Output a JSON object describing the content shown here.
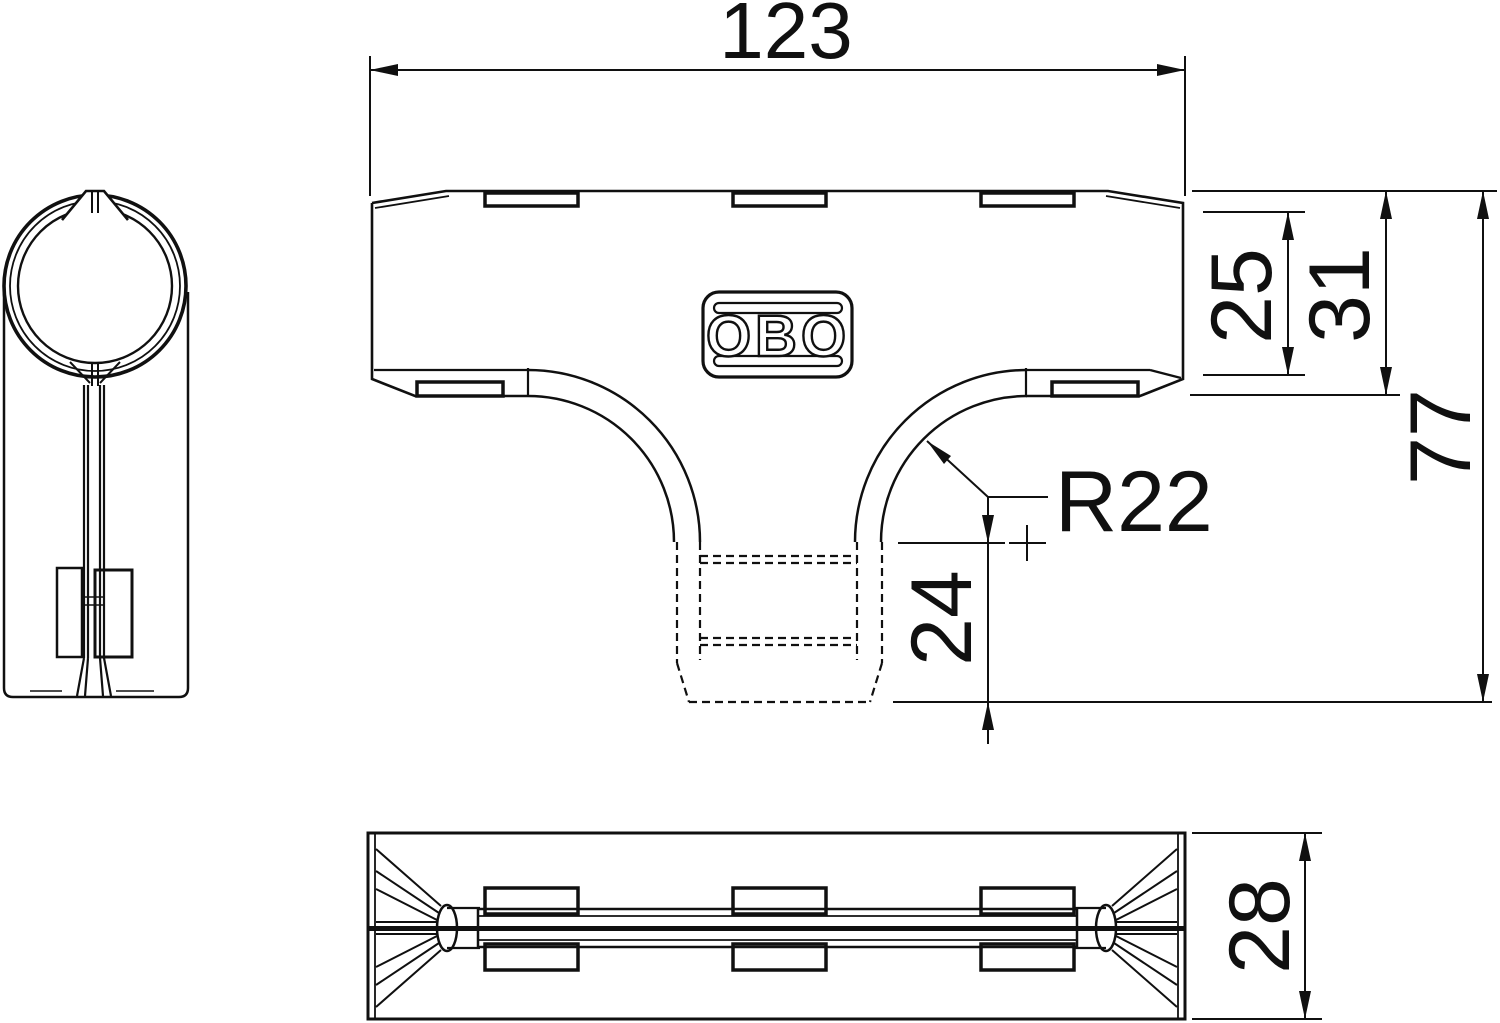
{
  "drawing": {
    "logo_text": "OBO",
    "dimensions": {
      "overall_width": "123",
      "lid_height": "25",
      "body_height": "31",
      "total_height": "77",
      "branch_radius": "R22",
      "branch_depth": "24",
      "duct_depth": "28"
    },
    "colors": {
      "line": "#101010",
      "background": "#ffffff"
    }
  }
}
